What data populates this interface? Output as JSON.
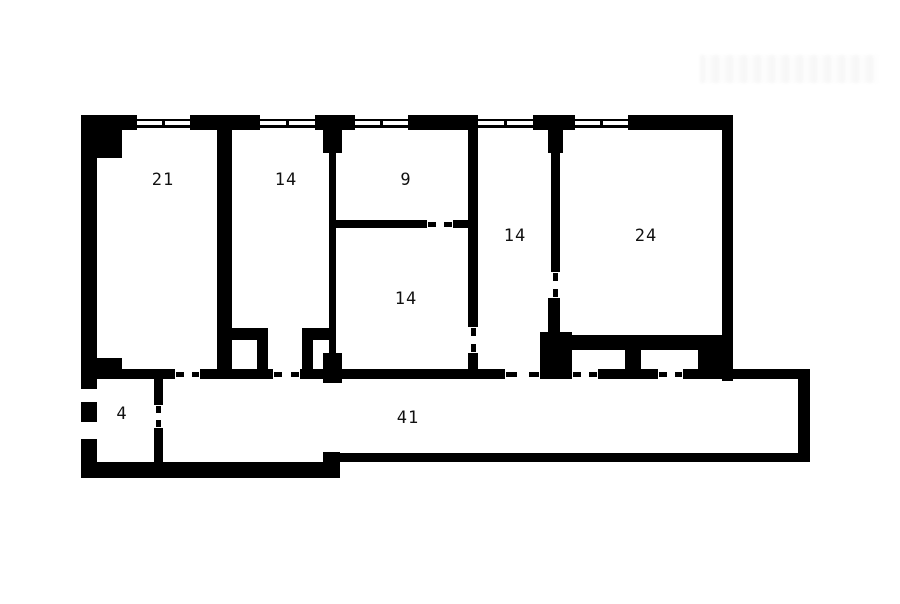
{
  "plan": {
    "ink": "#000000",
    "paper": "#ffffff",
    "walls": [
      {
        "name": "exterior-top-wall-seg1",
        "x": 81,
        "y": 115,
        "w": 56,
        "h": 15
      },
      {
        "name": "exterior-top-wall-seg2",
        "x": 190,
        "y": 115,
        "w": 70,
        "h": 15
      },
      {
        "name": "exterior-top-wall-seg3",
        "x": 315,
        "y": 115,
        "w": 40,
        "h": 15
      },
      {
        "name": "exterior-top-wall-seg4",
        "x": 408,
        "y": 115,
        "w": 70,
        "h": 15
      },
      {
        "name": "exterior-top-wall-seg5",
        "x": 533,
        "y": 115,
        "w": 42,
        "h": 15
      },
      {
        "name": "exterior-top-wall-seg6",
        "x": 628,
        "y": 115,
        "w": 105,
        "h": 15
      },
      {
        "name": "exterior-left-wall-upper",
        "x": 81,
        "y": 130,
        "w": 16,
        "h": 256
      },
      {
        "name": "exterior-left-wall-mid",
        "x": 81,
        "y": 404,
        "w": 16,
        "h": 15
      },
      {
        "name": "exterior-left-wall-lower",
        "x": 81,
        "y": 441,
        "w": 16,
        "h": 37
      },
      {
        "name": "exterior-bottom-wall-left",
        "x": 81,
        "y": 462,
        "w": 259,
        "h": 16
      },
      {
        "name": "exterior-bottom-step",
        "x": 323,
        "y": 452,
        "w": 17,
        "h": 26
      },
      {
        "name": "exterior-bottom-wall-right",
        "x": 340,
        "y": 453,
        "w": 470,
        "h": 9
      },
      {
        "name": "exterior-right-wall-corridor",
        "x": 798,
        "y": 373,
        "w": 12,
        "h": 89
      },
      {
        "name": "exterior-right-wall-room24",
        "x": 722,
        "y": 115,
        "w": 11,
        "h": 266
      },
      {
        "name": "room21-corner-step",
        "x": 97,
        "y": 130,
        "w": 25,
        "h": 28
      },
      {
        "name": "wall-room21-room14",
        "x": 217,
        "y": 130,
        "w": 15,
        "h": 239
      },
      {
        "name": "wall-room14-room9-pier-top",
        "x": 323,
        "y": 130,
        "w": 19,
        "h": 23
      },
      {
        "name": "wall-room14-room9",
        "x": 329,
        "y": 153,
        "w": 7,
        "h": 200
      },
      {
        "name": "wall-room14-room9-pier-bottom",
        "x": 323,
        "y": 353,
        "w": 19,
        "h": 30
      },
      {
        "name": "room9-bottom-wall-a",
        "x": 336,
        "y": 220,
        "w": 91,
        "h": 8
      },
      {
        "name": "room9-bottom-wall-b",
        "x": 453,
        "y": 220,
        "w": 15,
        "h": 8
      },
      {
        "name": "wall-room9-room14r",
        "x": 468,
        "y": 130,
        "w": 10,
        "h": 197
      },
      {
        "name": "wall-room9-room14r-stub",
        "x": 468,
        "y": 353,
        "w": 10,
        "h": 16
      },
      {
        "name": "wall-room14r-room24-pier-top",
        "x": 548,
        "y": 130,
        "w": 15,
        "h": 23
      },
      {
        "name": "wall-room14r-room24",
        "x": 551,
        "y": 153,
        "w": 9,
        "h": 119
      },
      {
        "name": "wall-room14r-room24-lower",
        "x": 548,
        "y": 298,
        "w": 12,
        "h": 37
      },
      {
        "name": "room24-bottom-thick-wall",
        "x": 560,
        "y": 335,
        "w": 173,
        "h": 15
      },
      {
        "name": "corridor-pier-a",
        "x": 540,
        "y": 332,
        "w": 32,
        "h": 47
      },
      {
        "name": "corridor-pier-b",
        "x": 625,
        "y": 350,
        "w": 16,
        "h": 29
      },
      {
        "name": "corridor-pier-c",
        "x": 698,
        "y": 350,
        "w": 24,
        "h": 29
      },
      {
        "name": "room4-top-pier",
        "x": 97,
        "y": 358,
        "w": 25,
        "h": 11
      },
      {
        "name": "corridor-top-wall-seg1",
        "x": 97,
        "y": 369,
        "w": 78,
        "h": 10
      },
      {
        "name": "corridor-top-wall-seg2",
        "x": 200,
        "y": 369,
        "w": 73,
        "h": 10
      },
      {
        "name": "corridor-top-wall-seg3",
        "x": 300,
        "y": 369,
        "w": 42,
        "h": 10
      },
      {
        "name": "corridor-top-wall-seg4",
        "x": 342,
        "y": 369,
        "w": 163,
        "h": 10
      },
      {
        "name": "corridor-top-wall-seg5",
        "x": 598,
        "y": 369,
        "w": 60,
        "h": 10
      },
      {
        "name": "corridor-top-wall-seg6",
        "x": 683,
        "y": 369,
        "w": 127,
        "h": 10
      },
      {
        "name": "closet-a-top-wall",
        "x": 232,
        "y": 328,
        "w": 36,
        "h": 12
      },
      {
        "name": "closet-a-right-wall",
        "x": 257,
        "y": 340,
        "w": 11,
        "h": 29
      },
      {
        "name": "closet-b-top-wall",
        "x": 302,
        "y": 328,
        "w": 34,
        "h": 12
      },
      {
        "name": "closet-b-left-wall",
        "x": 302,
        "y": 340,
        "w": 11,
        "h": 29
      },
      {
        "name": "room4-right-wall-upper",
        "x": 154,
        "y": 379,
        "w": 9,
        "h": 26
      },
      {
        "name": "room4-right-wall-lower",
        "x": 154,
        "y": 428,
        "w": 9,
        "h": 34
      }
    ],
    "windows": [
      {
        "name": "window-room21",
        "x": 137,
        "y": 115,
        "w": 53,
        "h": 15
      },
      {
        "name": "window-room14",
        "x": 260,
        "y": 115,
        "w": 55,
        "h": 15
      },
      {
        "name": "window-room9",
        "x": 355,
        "y": 115,
        "w": 53,
        "h": 15
      },
      {
        "name": "window-room14r",
        "x": 478,
        "y": 115,
        "w": 55,
        "h": 15
      },
      {
        "name": "window-room24",
        "x": 575,
        "y": 115,
        "w": 53,
        "h": 15
      }
    ],
    "left_openings": [
      {
        "name": "entry-opening-upper",
        "x": 81,
        "y": 386,
        "w": 16,
        "h": 18
      },
      {
        "name": "entry-opening-lower",
        "x": 81,
        "y": 419,
        "w": 16,
        "h": 22
      }
    ],
    "doors": [
      {
        "name": "door-room21",
        "x": 175,
        "y": 369,
        "w": 25,
        "h": 10,
        "o": "h"
      },
      {
        "name": "door-room14-left",
        "x": 273,
        "y": 369,
        "w": 27,
        "h": 10,
        "o": "h"
      },
      {
        "name": "door-room14-right",
        "x": 505,
        "y": 369,
        "w": 35,
        "h": 10,
        "o": "h"
      },
      {
        "name": "door-closet24-a",
        "x": 572,
        "y": 369,
        "w": 26,
        "h": 10,
        "o": "h"
      },
      {
        "name": "door-closet24-b",
        "x": 658,
        "y": 369,
        "w": 25,
        "h": 10,
        "o": "h"
      },
      {
        "name": "door-room9",
        "x": 427,
        "y": 220,
        "w": 26,
        "h": 8,
        "o": "h"
      },
      {
        "name": "door-room14-14",
        "x": 468,
        "y": 327,
        "w": 10,
        "h": 26,
        "o": "v"
      },
      {
        "name": "door-room24",
        "x": 551,
        "y": 272,
        "w": 9,
        "h": 26,
        "o": "v"
      },
      {
        "name": "door-room4",
        "x": 154,
        "y": 405,
        "w": 9,
        "h": 23,
        "o": "v"
      }
    ],
    "room_labels": [
      {
        "text": "21",
        "x": 163,
        "y": 180
      },
      {
        "text": "14",
        "x": 286,
        "y": 180
      },
      {
        "text": "9",
        "x": 406,
        "y": 180
      },
      {
        "text": "14",
        "x": 515,
        "y": 236
      },
      {
        "text": "24",
        "x": 646,
        "y": 236
      },
      {
        "text": "14",
        "x": 406,
        "y": 299
      },
      {
        "text": "4",
        "x": 122,
        "y": 414
      },
      {
        "text": "41",
        "x": 408,
        "y": 418
      }
    ],
    "watermark": {
      "x": 700,
      "y": 55,
      "w": 178,
      "h": 28
    }
  }
}
